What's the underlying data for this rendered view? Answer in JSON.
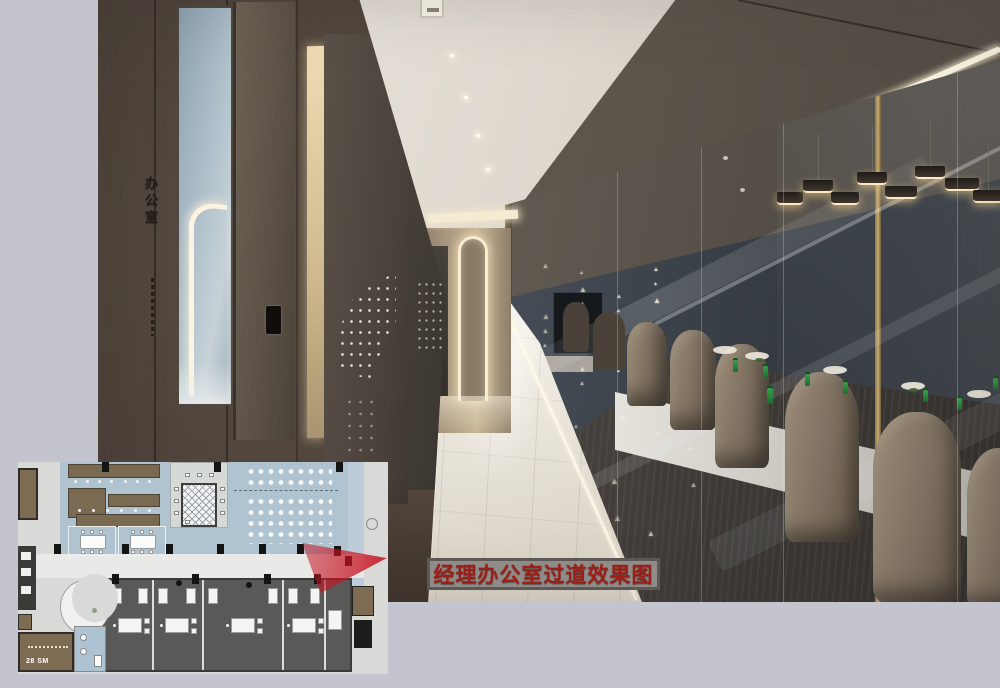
{
  "page": {
    "background_color": "#c3c4ce"
  },
  "photo": {
    "description": "corridor rendering with glass meeting room",
    "wall_sign_vertical": "办公室",
    "colors": {
      "left_wall_bronze": "#57493e",
      "meeting_room_wall": "#3a4047",
      "corridor_floor": "#ece7dd",
      "cove_light": "#fff8e6",
      "glass_mullion_gold": "#c9ab6e"
    }
  },
  "floor_plan": {
    "bottom_left_room_label": "28 SM",
    "colors": {
      "open_area_blue": "#afc3d1",
      "office_dark_gray": "#595957",
      "furniture_brown": "#7b6a52",
      "paper": "#d9d9d7"
    }
  },
  "annotation": {
    "caption": "经理办公室过道效果图",
    "caption_text_color": "#9c1f17",
    "caption_background": "#8f8c89",
    "caption_border": "#5b5856",
    "arrow_color": "#c81e2d",
    "arrow_direction": "right"
  }
}
